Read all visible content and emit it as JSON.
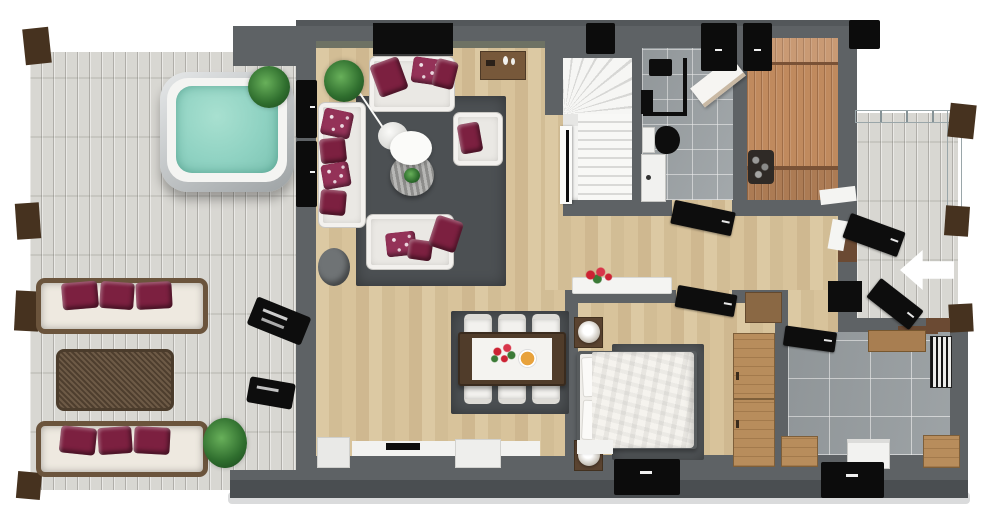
{
  "scene": {
    "kind": "3d-floor-plan-render-top-view",
    "canvas": {
      "width": 1000,
      "height": 507,
      "background": "#ffffff"
    },
    "entry_arrow": {
      "direction": "left"
    }
  },
  "palette": {
    "wall": "#5e6265",
    "wall_dark": "#4a4e51",
    "wall_edge": "#53575a",
    "wall_tint": "#6e7264",
    "ground_shadow": "#dadbdc",
    "black": "#0d0d0d",
    "white": "#f3f2f0",
    "rug": "#4c5053",
    "rug_bedroom": "#55595c",
    "pillow_maroon": "#7c2040",
    "pillow_pattern": "#943258",
    "hot_tub_water": "#8fd2c2",
    "hot_tub_rim": "#f4f4f2",
    "sauna_bench_edge": "#7a5236",
    "dark_wood": "#503c2a",
    "mid_wood": "#77583a",
    "night_wood": "#5a4330",
    "threshold": "#6b4a33",
    "post_brown": "#46321f",
    "plate_orange": "#e8a23c",
    "flower_red": "#cc2233",
    "leaf_green": "#3b7a36",
    "stool_gray": "#6f7375",
    "lamp_white": "#fbfbf9"
  },
  "rooms": [
    {
      "id": "left-deck",
      "floor": "whitewashed-planks"
    },
    {
      "id": "living-room",
      "floor": "light-oak"
    },
    {
      "id": "dining-area",
      "floor": "light-oak"
    },
    {
      "id": "staircase",
      "floor": "white-stairs"
    },
    {
      "id": "bathroom",
      "floor": "gray-tile"
    },
    {
      "id": "sauna",
      "floor": "cedar-wood"
    },
    {
      "id": "hallway",
      "floor": "light-oak"
    },
    {
      "id": "bedroom",
      "floor": "light-oak"
    },
    {
      "id": "mudroom",
      "floor": "gray-tile"
    },
    {
      "id": "entry-porch-balcony",
      "floor": "whitewashed-planks"
    }
  ],
  "furniture": {
    "left_deck": [
      "hot-tub",
      "outdoor-sofa-top",
      "outdoor-sofa-bottom",
      "wicker-coffee-table",
      "plant-top",
      "plant-bottom",
      "wall-lamp-1",
      "wall-lamp-2"
    ],
    "living_room": [
      "tv",
      "media-sideboard",
      "sofa-top",
      "sofa-left",
      "loveseat-bottom",
      "armchair",
      "round-coffee-table",
      "arc-floor-lamp",
      "corner-plant",
      "ottoman",
      "area-rug"
    ],
    "dining_area": [
      "dining-table",
      "table-runner",
      "flower-centerpiece",
      "fruit-plate",
      "6-chairs",
      "area-rug"
    ],
    "bathroom": [
      "shower",
      "toilet",
      "sink-vanity",
      "bench"
    ],
    "sauna": [
      "benches",
      "sauna-heater"
    ],
    "hallway": [
      "console-table",
      "flowers",
      "shoe-cabinet",
      "black-cabinet"
    ],
    "bedroom": [
      "double-bed",
      "duvet",
      "2-pillows",
      "nightstand-top",
      "nightstand-bottom",
      "2-table-lamps",
      "wardrobe",
      "area-rug"
    ],
    "mudroom": [
      "bench",
      "wood-cabinet-left",
      "washing-machine",
      "wood-cabinet-right",
      "doormat"
    ],
    "porch": [
      "glass-railing",
      "entry-arrow",
      "open-door"
    ]
  }
}
